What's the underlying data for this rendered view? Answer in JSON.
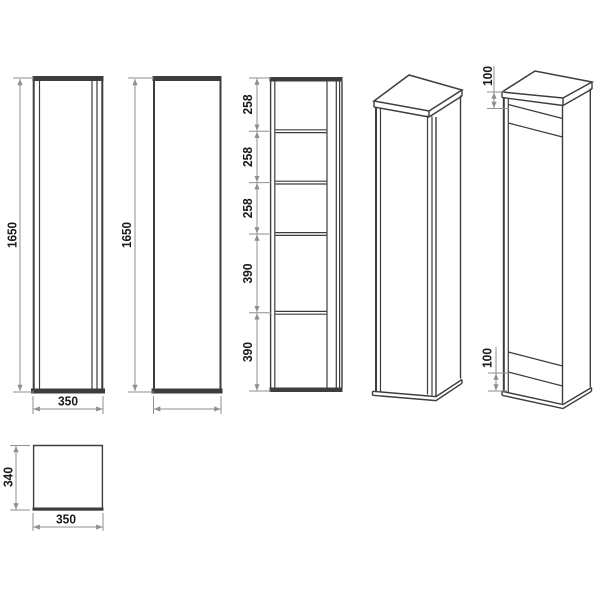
{
  "title": "cabinet-technical-drawing",
  "views": {
    "front": {
      "height": "1650",
      "width": "350"
    },
    "side": {
      "height": "1650",
      "width": "340"
    },
    "sections": {
      "segments": [
        "258",
        "258",
        "258",
        "390",
        "390"
      ]
    },
    "top": {
      "depth": "340",
      "width": "350"
    },
    "perspective_detail": {
      "top_inset": "100",
      "bottom_inset": "100"
    }
  },
  "colors": {
    "background": "#ffffff",
    "outline": "#3d3d3d",
    "dimension_line": "#8f8f8f",
    "label": "#1a1a1a"
  }
}
